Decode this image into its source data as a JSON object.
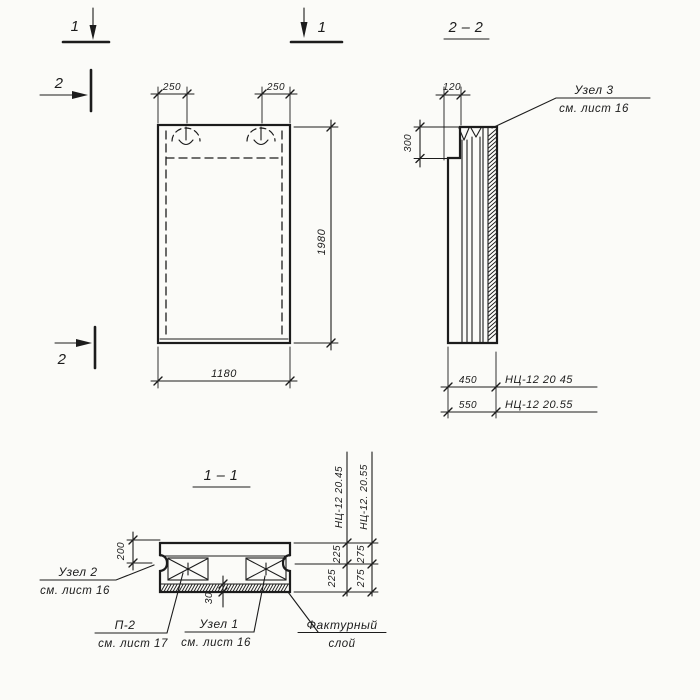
{
  "drawing": {
    "colors": {
      "ink": "#1c1c1c",
      "paper": "#fbfbf8"
    },
    "markers": {
      "left1": "1",
      "right1": "1",
      "top2": "2",
      "bottom2": "2"
    },
    "front_view": {
      "dim_loop_left": "250",
      "dim_loop_right": "250",
      "dim_height": "1980",
      "dim_width": "1180"
    },
    "side_view": {
      "title": "2 – 2",
      "dim_top_width": "120",
      "dim_top_offset": "300",
      "rows": [
        {
          "dim": "450",
          "mark": "НЦ-12 20 45"
        },
        {
          "dim": "550",
          "mark": "НЦ-12 20.55"
        }
      ],
      "node3": {
        "title": "Узел 3",
        "ref": "см. лист 16"
      }
    },
    "section_view": {
      "title": "1 – 1",
      "dim_edge": "200",
      "dim_layer": "30",
      "chains": [
        {
          "mark": "НЦ-12 20.45",
          "top": "225",
          "bottom": "225"
        },
        {
          "mark": "НЦ-12. 20.55",
          "top": "275",
          "bottom": "275"
        }
      ],
      "node2": {
        "title": "Узел 2",
        "ref": "см. лист 16"
      },
      "p2": {
        "title": "П-2",
        "ref": "см. лист 17"
      },
      "node1": {
        "title": "Узел 1",
        "ref": "см. лист 16"
      },
      "texture": {
        "line1": "Фактурный",
        "line2": "слой"
      }
    }
  }
}
